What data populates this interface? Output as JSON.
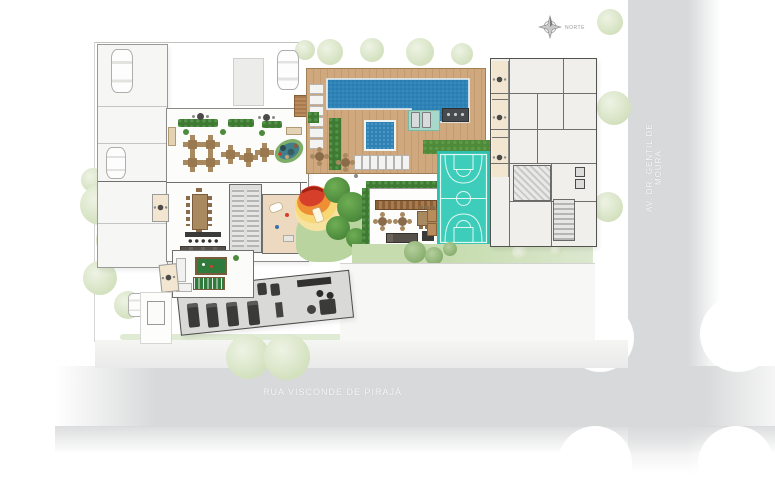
{
  "streets": {
    "bottom": {
      "label": "RUA VISCONDE DE PIRAJÁ"
    },
    "right": {
      "label": "AV. DR. GENTIL DE MOURA"
    }
  },
  "compass": {
    "label": "NORTE",
    "icon": "compass-rose"
  },
  "colors": {
    "street": "#d8d9da",
    "pool_water": "#2e82b6",
    "wood_deck": "#c9a277",
    "sport_court": "#38c8b4",
    "lawn": "#b9d49e",
    "playground_red": "#d6402b",
    "playground_orange": "#ef8f33",
    "playground_yellow": "#f7d875",
    "tree_dark": "#4c8a3c",
    "tree_pale": "#d7e4c6",
    "building_fill": "#f0efec",
    "wall": "#5f5f5d"
  }
}
